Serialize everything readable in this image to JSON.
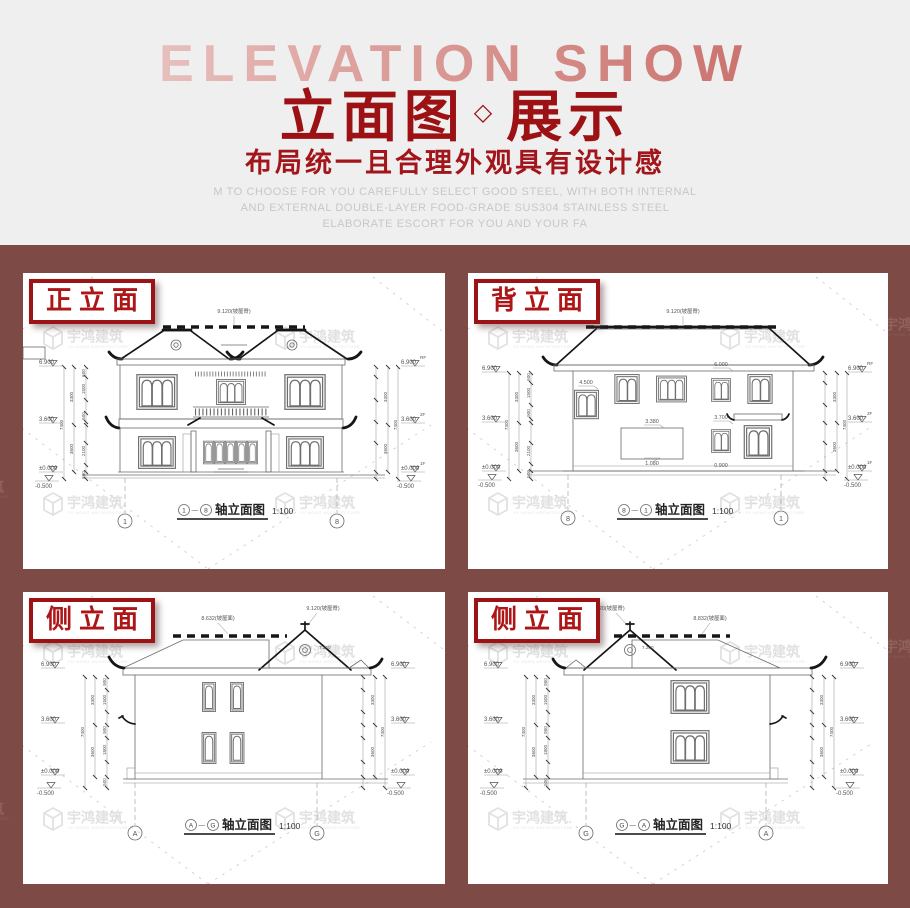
{
  "hero": {
    "en_title": "ELEVATION SHOW",
    "title_main": "立面图",
    "title_diamond": "◇",
    "title_tail": "展示",
    "subtitle": "布局统一且合理外观具有设计感",
    "desc_lines": [
      "M TO CHOOSE FOR YOU CAREFULLY SELECT GOOD STEEL, WITH BOTH INTERNAL",
      "AND EXTERNAL DOUBLE-LAYER FOOD-GRADE SUS304 STAINLESS STEEL",
      "ELABORATE ESCORT FOR YOU AND YOUR FA"
    ]
  },
  "watermark": {
    "cn": "宇鸿建筑",
    "en": "YU HONG ARCHITECTURE"
  },
  "colors": {
    "hero_bg": "#efeff0",
    "board_bg": "#7d4a46",
    "title_red": "#9c1114",
    "label_border_red": "#9b1315",
    "label_text_red": "#ad1517",
    "drawing_line": "#6a6a6a"
  },
  "markers": {
    "rf_label": "RF",
    "rf": "6.900",
    "f2_label": "2F",
    "f2": "3.600",
    "f1_label": "1F",
    "f1": "±0.000",
    "base": "-0.500",
    "base_dim": "500",
    "total": "7400"
  },
  "cards": [
    {
      "label": "正立面",
      "ridge_label": "9.120(坡屋脊)",
      "axis_left": "1",
      "axis_right": "8",
      "caption_dash": "—",
      "caption_title": "轴立面图",
      "caption_scale": "1:100",
      "dims_inner": [
        "600",
        "1500",
        "900",
        "600",
        "2100",
        "900"
      ],
      "dims_outer": [
        "3300",
        "3600"
      ]
    },
    {
      "label": "背立面",
      "ridge_label": "9.120(坡屋脊)",
      "axis_left": "8",
      "axis_right": "1",
      "caption_dash": "—",
      "caption_title": "轴立面图",
      "caption_scale": "1:100",
      "dims_inner": [
        "600",
        "1500",
        "900",
        "600",
        "2100",
        "900"
      ],
      "dims_outer": [
        "3300",
        "3600"
      ],
      "annotations": [
        "4.500",
        "6.000",
        "3.380",
        "1.080",
        "3.700",
        "0.900"
      ]
    },
    {
      "label": "侧立面",
      "roof_label_left": "8.632(坡屋面)",
      "roof_label_right": "9.120(坡屋脊)",
      "gable_ann": "7.200",
      "axis_left": "A",
      "axis_right": "G",
      "caption_dash": "—",
      "caption_title": "轴立面图",
      "caption_scale": "1:100",
      "dims_inner": [
        "900",
        "1500",
        "900",
        "900",
        "1800",
        "900"
      ],
      "dims_outer": [
        "3300",
        "3600"
      ]
    },
    {
      "label": "侧立面",
      "roof_label_left": "9.120(坡屋脊)",
      "roof_label_right": "8.832(坡屋面)",
      "gable_ann": "7.200",
      "axis_left": "G",
      "axis_right": "A",
      "caption_dash": "—",
      "caption_title": "轴立面图",
      "caption_scale": "1:100",
      "dims_inner": [
        "900",
        "1500",
        "900",
        "900",
        "1800",
        "900"
      ],
      "dims_outer": [
        "3300",
        "3600"
      ]
    }
  ]
}
